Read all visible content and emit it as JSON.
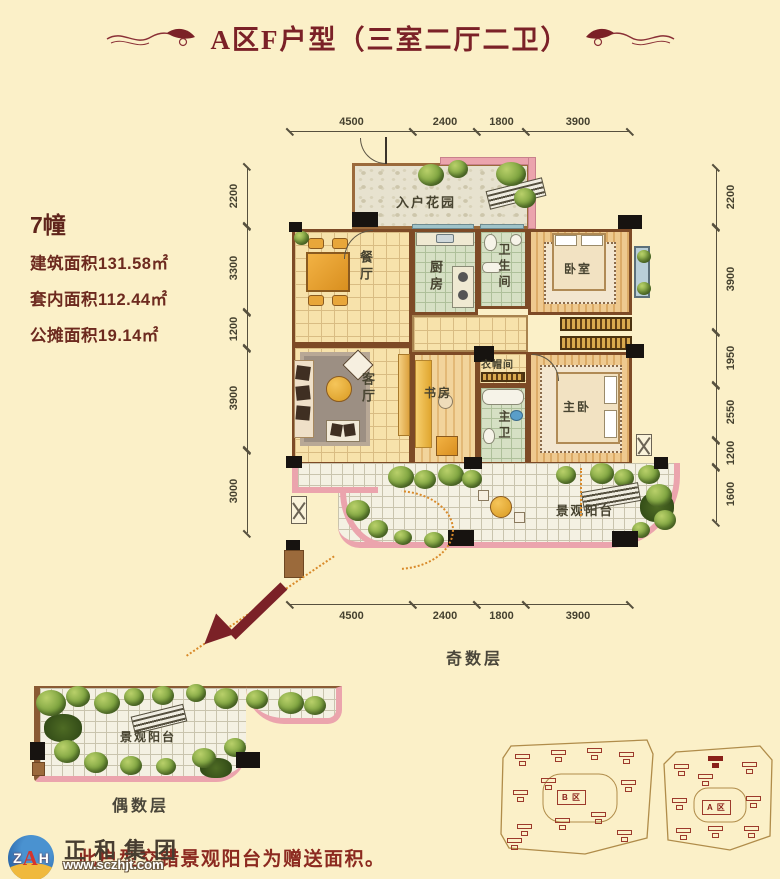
{
  "title": {
    "text": "A区F户型（三室二厅二卫）"
  },
  "info": {
    "building": "7幢",
    "built_area": "建筑面积131.58㎡",
    "inner_area": "套内面积112.44㎡",
    "shared_area": "公摊面积19.14㎡"
  },
  "dims": {
    "top": [
      "4500",
      "2400",
      "1800",
      "3900"
    ],
    "bottom": [
      "4500",
      "2400",
      "1800",
      "3900"
    ],
    "left": [
      "2200",
      "3300",
      "1200",
      "3900",
      "3000"
    ],
    "right": [
      "2200",
      "3900",
      "1950",
      "2550",
      "1200",
      "1600"
    ]
  },
  "rooms": {
    "entry_garden": "入户花园",
    "dining": "餐厅",
    "kitchen": "厨房",
    "bathroom": "卫生间",
    "bedroom": "卧室",
    "living": "客厅",
    "study": "书房",
    "cloakroom": "衣帽间",
    "master_bath": "主卫",
    "master_bedroom": "主卧",
    "balcony": "景观阳台"
  },
  "floor_labels": {
    "odd": "奇数层",
    "even": "偶数层"
  },
  "note": {
    "text": "此户型交错景观阳台为赠送面积。"
  },
  "logo": {
    "m1": "Z",
    "m2": "A",
    "m3": "H",
    "company": "正和集团",
    "website": "www.sczhjt.com"
  },
  "site_plans": {
    "b": {
      "label": "B 区"
    },
    "a": {
      "label": "A 区"
    }
  },
  "colors": {
    "accent": "#7b2127",
    "balcony_pink": "#eba4ad",
    "tree_green": "#7da33f",
    "background": "#fbf0c8",
    "wall_brown": "#7d4a26"
  }
}
